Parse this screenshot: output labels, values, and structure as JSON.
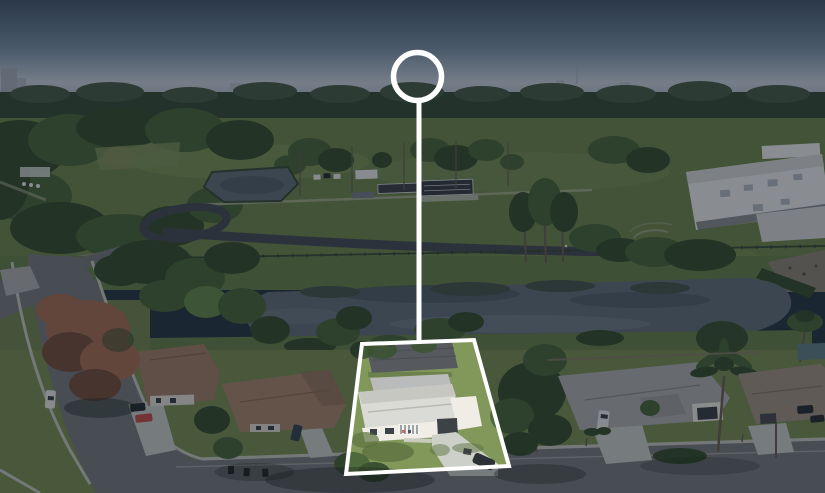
{
  "scene": {
    "description": "Aerial drone photograph of a suburban neighborhood beside a school athletic field with a running track, batting cages, a small retention pond and a large pond. A row of single-family homes lines a curving street in the foreground. One residential lot is highlighted with a white outline, a vertical white locator line and a white circle marker at the top; the rest of the photo is dimmed.",
    "photo_type": "real-estate aerial lot highlight",
    "visible_text": ""
  },
  "annotations": {
    "marker_circle": {
      "cx": 417.5,
      "cy": 76.5,
      "r": 24,
      "stroke_width": 5.5,
      "color": "#ffffff"
    },
    "connector_line": {
      "x1": 419,
      "y1": 103,
      "x2": 419,
      "y2": 342,
      "width": 5,
      "color": "#ffffff"
    },
    "lot_outline": {
      "points": "362,344 474,340 509,466 346,474",
      "stroke_width": 4,
      "color": "#ffffff"
    },
    "dim_overlay": {
      "path": "M0 0H825V493H0Z M362 344L474 340L509 466L346 474Z",
      "color": "rgba(6,14,28,0.44)"
    }
  },
  "colors": {
    "sky_top": "#46596c",
    "sky_mid": "#8096a9",
    "sky_horizon": "#ccd6dd",
    "sky_haze": "#b7c3cc",
    "city": "#a7b1bb",
    "far_trees": "#4a6148",
    "far_trees_dark": "#3a4f37",
    "field": "#71894e",
    "field_light": "#82995c",
    "bank": "#6a844c",
    "lawn": "#7d9254",
    "lawn_shade": "#5e7241",
    "subject_lawn": "#82985a",
    "tree_dark": "#3a5230",
    "tree_mid": "#4e6a3c",
    "tree_light": "#688c4b",
    "pine_trunk": "#6e6353",
    "autumn": "#aa7254",
    "autumn_dark": "#7c523e",
    "pond_water": "#66727b",
    "pond_dark": "#525e68",
    "pond_reflection": "#49584f",
    "pond_light": "#7e8b95",
    "track": "#4a4f56",
    "path_light": "#abb495",
    "bleacher": "#79818a",
    "asphalt": "#7b7d7f",
    "asphalt_dark": "#6a6c6f",
    "sidewalk": "#c9cbc0",
    "concrete": "#cdd0c9",
    "school_wall": "#eff1ef",
    "school_wall_shade": "#d9dcd8",
    "roof_vent": "#b7bcc0",
    "window_dark": "#3d4247",
    "subject_roof": "#dadbd6",
    "subject_roof_shade": "#c6c7c1",
    "subject_wall": "#efede6",
    "back_roof": "#565a5e",
    "shed_roof": "#b9bcba",
    "brown_roof": "#a5826a",
    "tan_roof": "#ab8a6e",
    "tan_roof_dark": "#96765c",
    "gray_roof": "#b2b3b1",
    "gray_roof_dark": "#a2a4a2",
    "right_roof": "#a59685",
    "teal_shed": "#64828a",
    "rubble": "#908876",
    "fence_wood": "#8d7f6c",
    "red_car": "#c8534a",
    "white_car": "#eceeec",
    "dark_car": "#2c3135",
    "blue_car": "#3a4656",
    "pole": "#6b6458",
    "bin": "#24292d",
    "shadow": "#1f2a1c",
    "sand": "#d2c298"
  }
}
